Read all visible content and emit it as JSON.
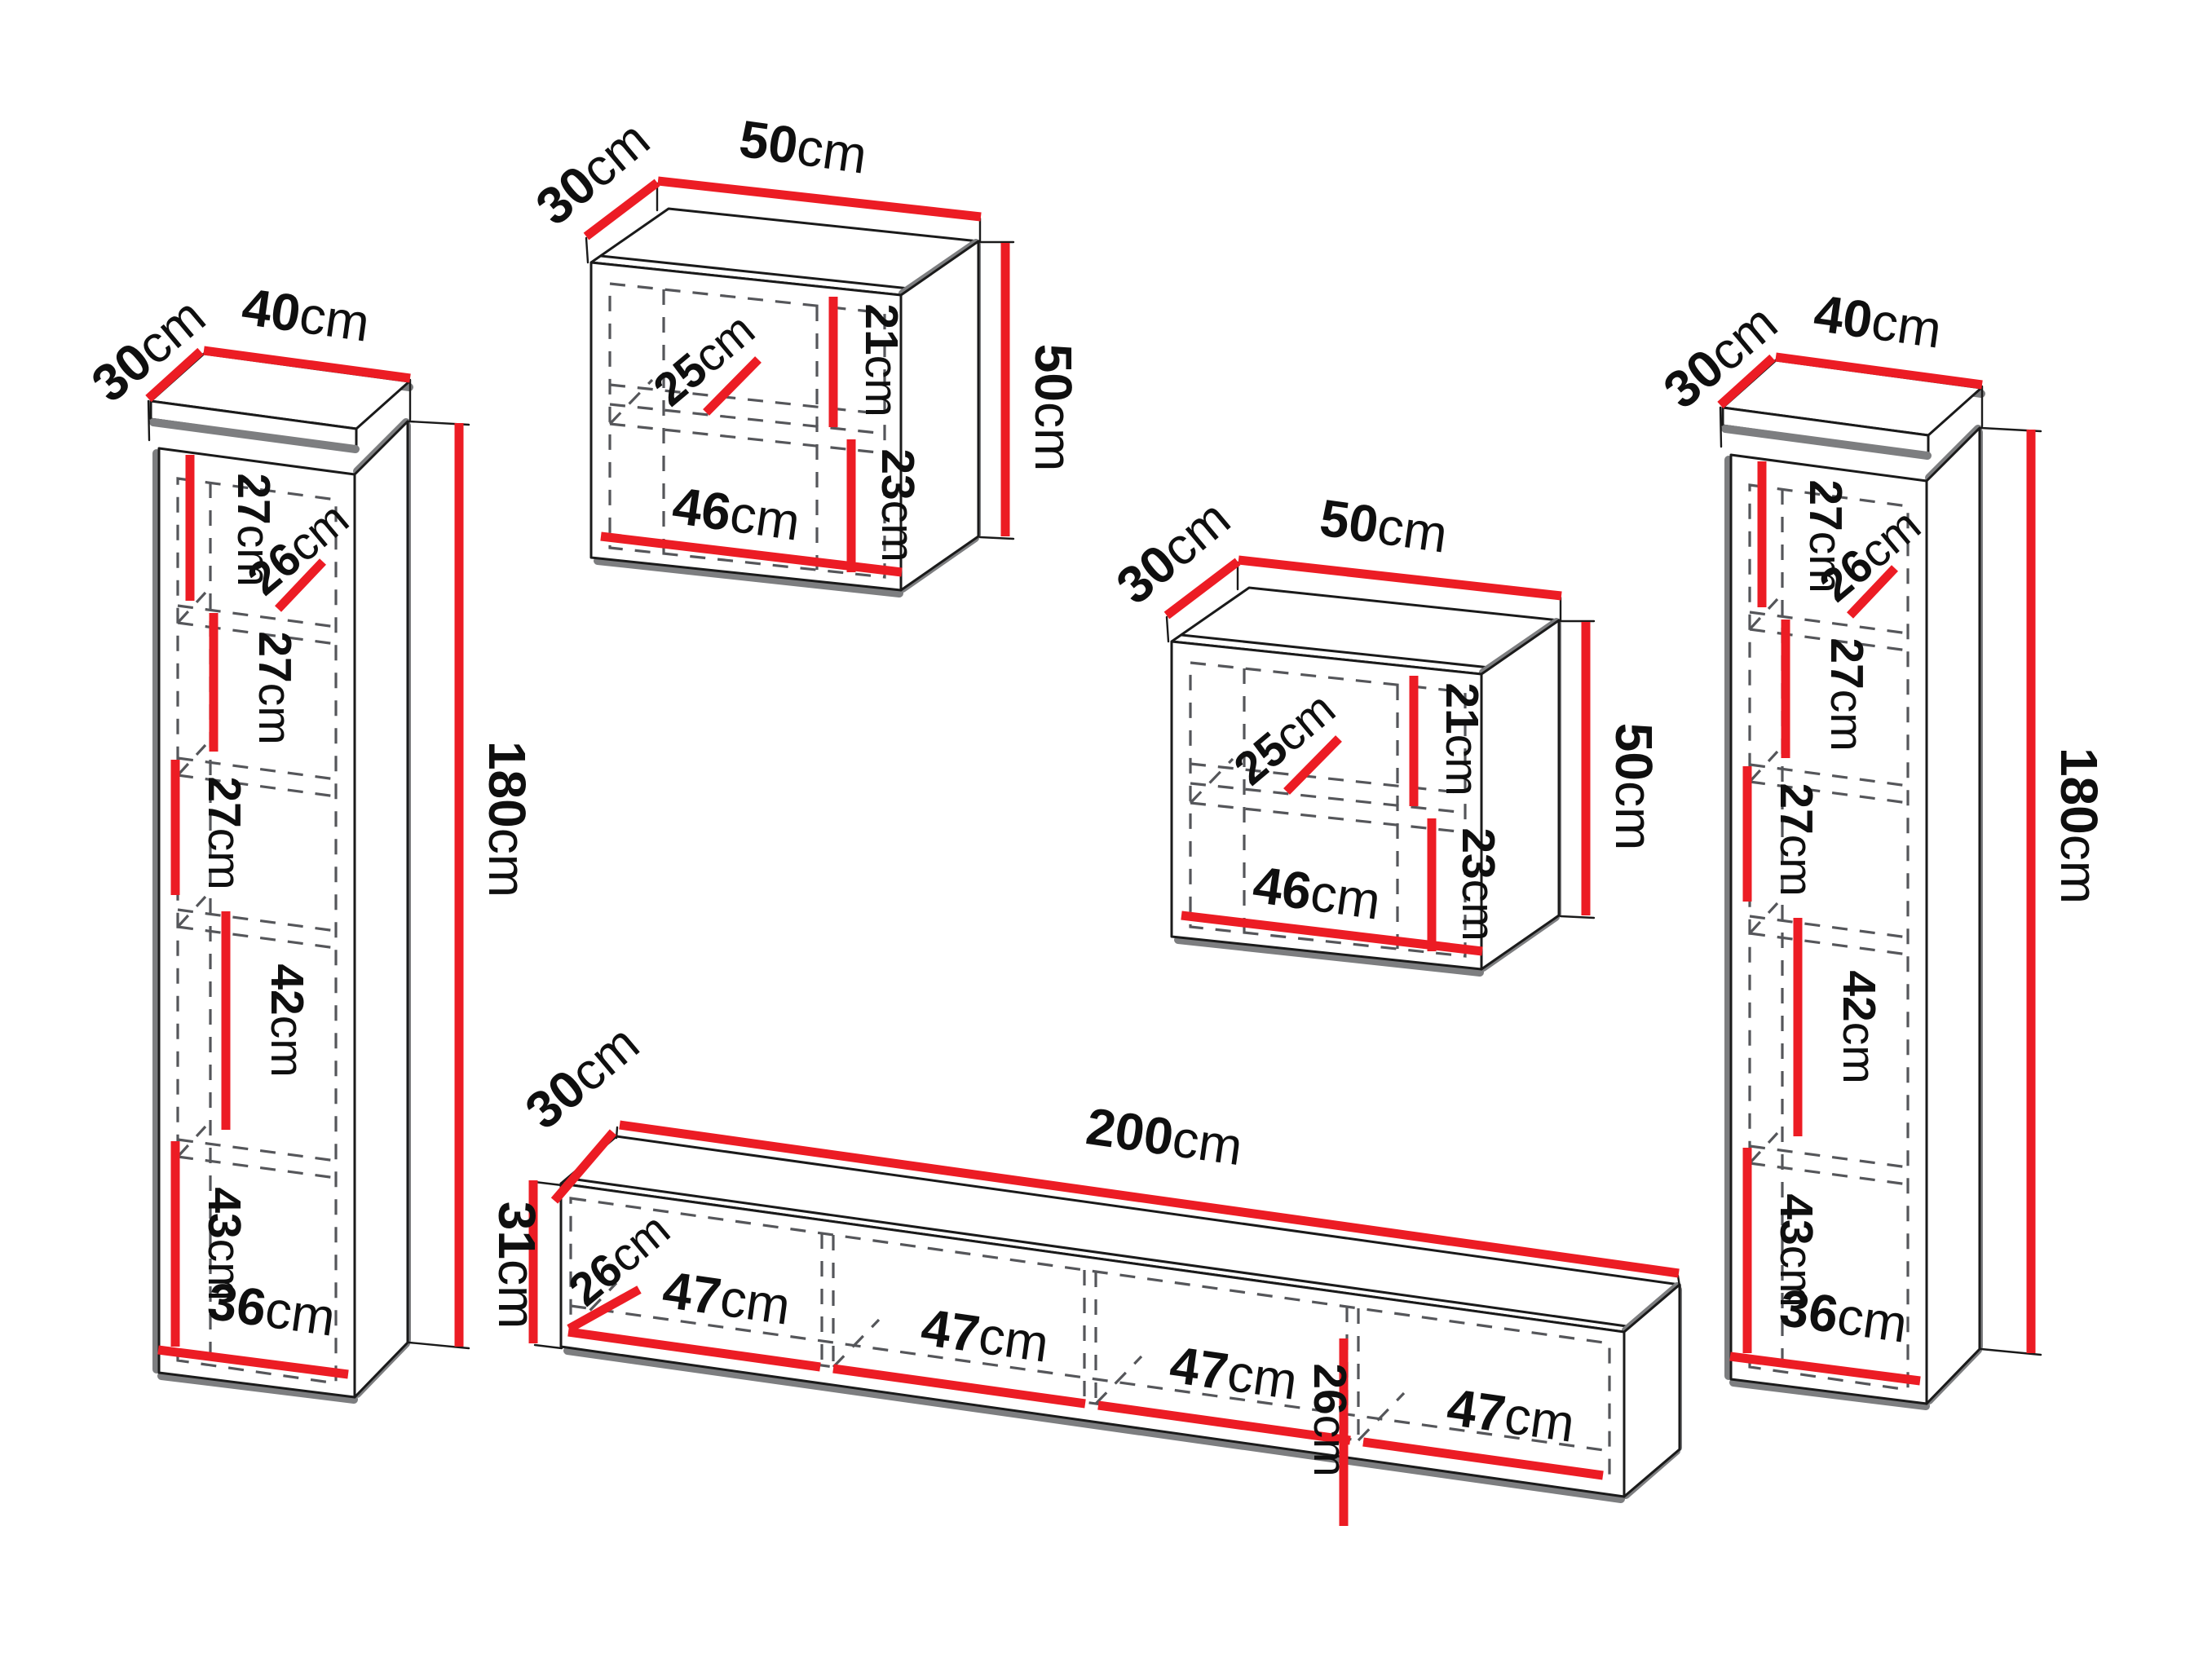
{
  "diagram": {
    "type": "furniture-dimension-diagram",
    "unit": "cm",
    "colors": {
      "dimension_red": "#ec1c24",
      "outline": "#1a1a1a",
      "shadow_gray": "#7d7e80",
      "dash_gray": "#55565a"
    },
    "furniture": {
      "left_column": {
        "depth": {
          "num": "30",
          "unit": "cm"
        },
        "width": {
          "num": "40",
          "unit": "cm"
        },
        "height": {
          "num": "180",
          "unit": "cm"
        },
        "shelf1": {
          "num": "27",
          "unit": "cm"
        },
        "inner_depth": {
          "num": "26",
          "unit": "cm"
        },
        "shelf2": {
          "num": "27",
          "unit": "cm"
        },
        "shelf3": {
          "num": "27",
          "unit": "cm"
        },
        "shelf4": {
          "num": "42",
          "unit": "cm"
        },
        "shelf5": {
          "num": "43",
          "unit": "cm"
        },
        "inner_width": {
          "num": "36",
          "unit": "cm"
        }
      },
      "wall_cabinet_top": {
        "depth": {
          "num": "30",
          "unit": "cm"
        },
        "width": {
          "num": "50",
          "unit": "cm"
        },
        "height": {
          "num": "50",
          "unit": "cm"
        },
        "upper_section": {
          "num": "21",
          "unit": "cm"
        },
        "shelf_depth": {
          "num": "25",
          "unit": "cm"
        },
        "lower_section": {
          "num": "23",
          "unit": "cm"
        },
        "inner_width": {
          "num": "46",
          "unit": "cm"
        }
      },
      "wall_cabinet_middle": {
        "depth": {
          "num": "30",
          "unit": "cm"
        },
        "width": {
          "num": "50",
          "unit": "cm"
        },
        "height": {
          "num": "50",
          "unit": "cm"
        },
        "upper_section": {
          "num": "21",
          "unit": "cm"
        },
        "shelf_depth": {
          "num": "25",
          "unit": "cm"
        },
        "lower_section": {
          "num": "23",
          "unit": "cm"
        },
        "inner_width": {
          "num": "46",
          "unit": "cm"
        }
      },
      "tv_stand": {
        "depth": {
          "num": "30",
          "unit": "cm"
        },
        "width": {
          "num": "200",
          "unit": "cm"
        },
        "height": {
          "num": "31",
          "unit": "cm"
        },
        "inner_depth": {
          "num": "26",
          "unit": "cm"
        },
        "inner_height": {
          "num": "26",
          "unit": "cm"
        },
        "compartments": [
          {
            "num": "47",
            "unit": "cm"
          },
          {
            "num": "47",
            "unit": "cm"
          },
          {
            "num": "47",
            "unit": "cm"
          },
          {
            "num": "47",
            "unit": "cm"
          }
        ]
      },
      "right_column": {
        "depth": {
          "num": "30",
          "unit": "cm"
        },
        "width": {
          "num": "40",
          "unit": "cm"
        },
        "height": {
          "num": "180",
          "unit": "cm"
        },
        "shelf1": {
          "num": "27",
          "unit": "cm"
        },
        "inner_depth": {
          "num": "26",
          "unit": "cm"
        },
        "shelf2": {
          "num": "27",
          "unit": "cm"
        },
        "shelf3": {
          "num": "27",
          "unit": "cm"
        },
        "shelf4": {
          "num": "42",
          "unit": "cm"
        },
        "shelf5": {
          "num": "43",
          "unit": "cm"
        },
        "inner_width": {
          "num": "36",
          "unit": "cm"
        }
      }
    }
  }
}
